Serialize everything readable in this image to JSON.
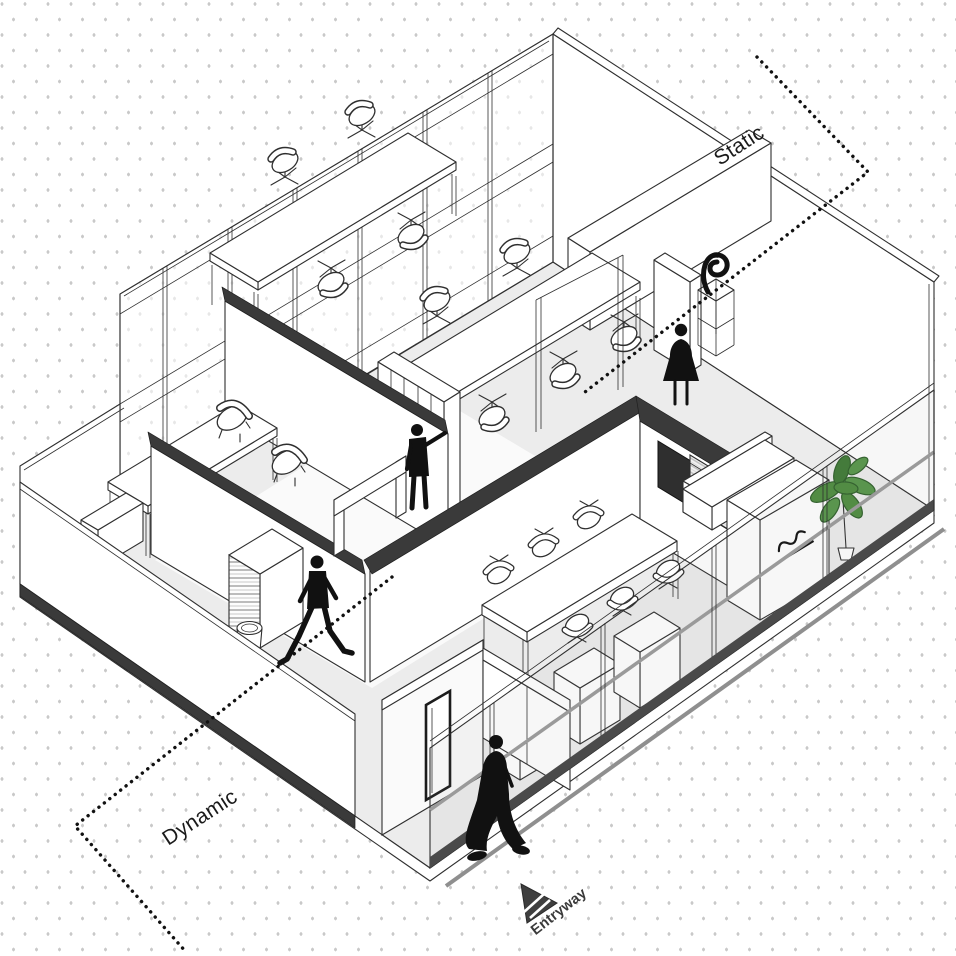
{
  "page": {
    "type": "axonometric-diagram",
    "subject": "office floor plan with circulation zones"
  },
  "labels": {
    "static": "Static",
    "dynamic": "Dynamic",
    "entryway": "Entryway"
  },
  "colors": {
    "background": "#ffffff",
    "dot_grid": "#c9c9c9",
    "linework": "#2f2f2f",
    "floor": "#ececec",
    "wall_cut_dark": "#3a3a3a",
    "base_trim": "#4a4a4a",
    "handrail_gray": "#999999",
    "slab_stripe": "#8f8f8f",
    "figure_black": "#111111",
    "tv_screen": "#2f2f2f",
    "plant_green": "#4e8c3f",
    "plant_green_dark": "#2f5f2a"
  },
  "figures": [
    "walking-man",
    "shelf-browsing-man",
    "standing-woman",
    "walking-woman"
  ],
  "furniture": [
    "open-office-desks",
    "office-chairs",
    "grid-bookshelf",
    "lounge-table",
    "lounge-armchairs",
    "conference-table",
    "conference-chairs",
    "tv-screen",
    "reception-desk",
    "reception-sofa",
    "marble-counter",
    "plant",
    "sculpture-display",
    "louver-cabinet",
    "trash-bin",
    "entry-door"
  ]
}
